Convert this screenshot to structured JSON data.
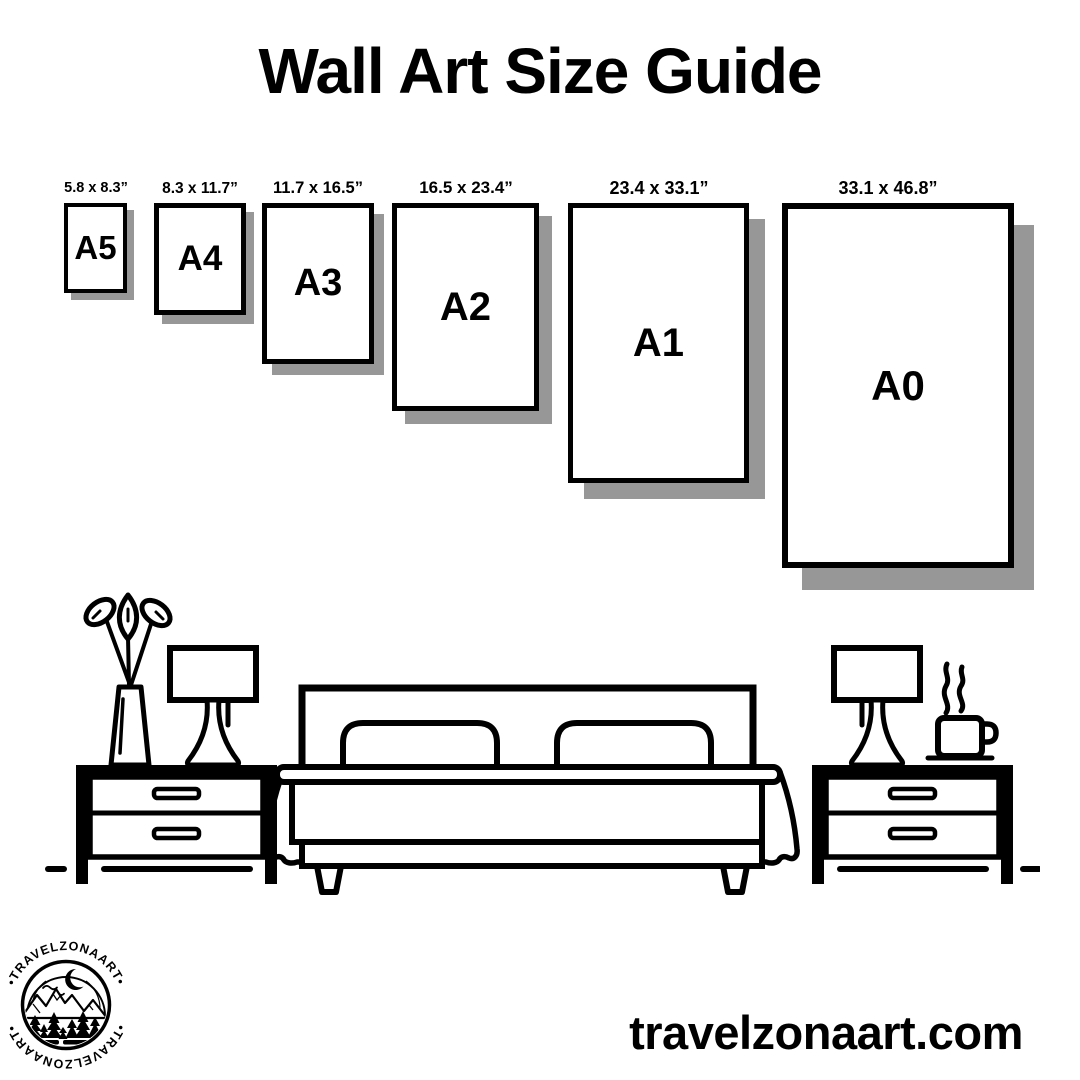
{
  "page": {
    "title": "Wall Art Size Guide"
  },
  "size_guide": {
    "items": [
      {
        "code": "A5",
        "dimensions": "5.8 x 8.3”"
      },
      {
        "code": "A4",
        "dimensions": "8.3 x 11.7”"
      },
      {
        "code": "A3",
        "dimensions": "11.7 x 16.5”"
      },
      {
        "code": "A2",
        "dimensions": "16.5 x 23.4”"
      },
      {
        "code": "A1",
        "dimensions": "23.4 x 33.1”"
      },
      {
        "code": "A0",
        "dimensions": "33.1 x 46.8”"
      }
    ]
  },
  "illustration": {
    "icons": [
      "plant-vase-icon",
      "table-lamp-icon",
      "nightstand-icon",
      "bed-icon",
      "pillow-icon",
      "coffee-cup-icon",
      "steam-icon",
      "floor-line"
    ]
  },
  "footer": {
    "website": "travelzonaart.com",
    "logo": {
      "arc_text_top": "•TRAVELZONAART•",
      "arc_text_bottom": "•TRAVELZONAART•",
      "icons": [
        "crescent-moon-icon",
        "birds-icon",
        "mountains-icon",
        "pine-trees-icon",
        "lake-icon"
      ]
    }
  },
  "colors": {
    "ink": "#000000",
    "paper": "#ffffff",
    "shadow": "#979797"
  }
}
